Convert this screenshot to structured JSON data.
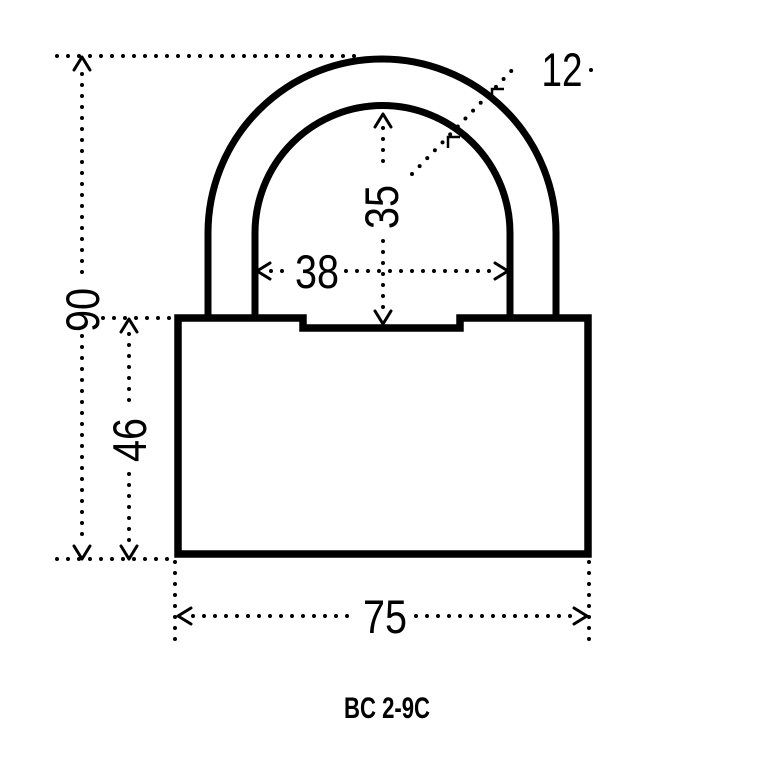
{
  "drawing": {
    "type": "padlock-technical-drawing",
    "model": "BC 2-9C",
    "dimensions": {
      "total_height": "90",
      "body_height": "46",
      "body_width": "75",
      "shackle_inner_width": "38",
      "shackle_inner_height": "35",
      "shackle_thickness": "12"
    },
    "colors": {
      "line": "#000000",
      "background": "#ffffff"
    }
  }
}
